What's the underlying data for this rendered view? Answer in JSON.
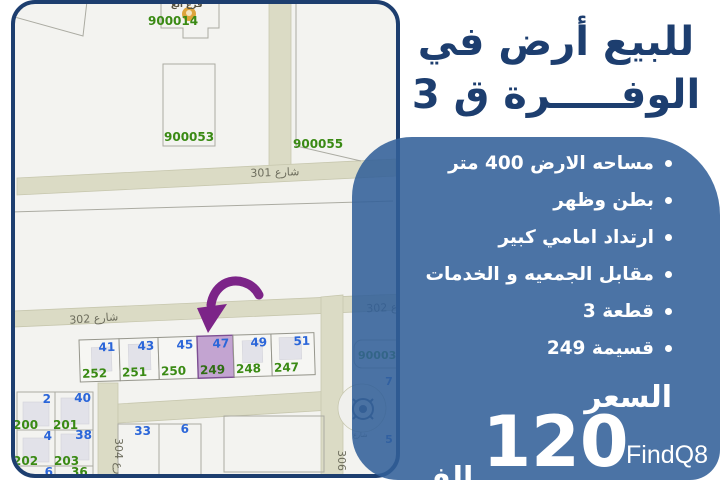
{
  "title": {
    "line1": "للبيع أرض في",
    "line2": "الوفـــــرة ق 3"
  },
  "panel": {
    "bullets": [
      "مساحه الارض 400 متر",
      "بطن وظهر",
      "ارتداد امامي كبير",
      "مقابل الجمعيه و الخدمات",
      "قطعة 3",
      "قسيمة 249"
    ],
    "price_label": "السعر",
    "price_value": "120",
    "price_unit": "الف"
  },
  "watermark": "FindQ8",
  "map": {
    "branch_label": "فرع الع",
    "parcel_numbers": {
      "a": "900014",
      "b": "900053",
      "c": "900055",
      "d": "900035"
    },
    "streets": {
      "s301": "شارع 301",
      "s302": "شارع 302",
      "s304": "شارع 304",
      "s306": "شارع 306",
      "edge": "شارع",
      "mini": "شارع"
    },
    "plot_row": {
      "top": [
        "41",
        "43",
        "45",
        "47",
        "49",
        "51"
      ],
      "bottom": [
        "252",
        "251",
        "250",
        "249",
        "248",
        "247"
      ]
    },
    "left_block_blue": [
      "2",
      "40",
      "4",
      "38",
      "6"
    ],
    "left_block_green": [
      "200",
      "201",
      "202",
      "203",
      "36"
    ],
    "mid_block": [
      "33",
      "6"
    ],
    "right_labels": [
      "7",
      "5"
    ]
  },
  "colors": {
    "navy": "#1d3e6f",
    "panel-blue": "#4d75a5",
    "arrow-purple": "#7c2488",
    "highlight-purple": "#c3a4d1",
    "number-blue": "#2b66d9",
    "number-green": "#3a8a14"
  }
}
